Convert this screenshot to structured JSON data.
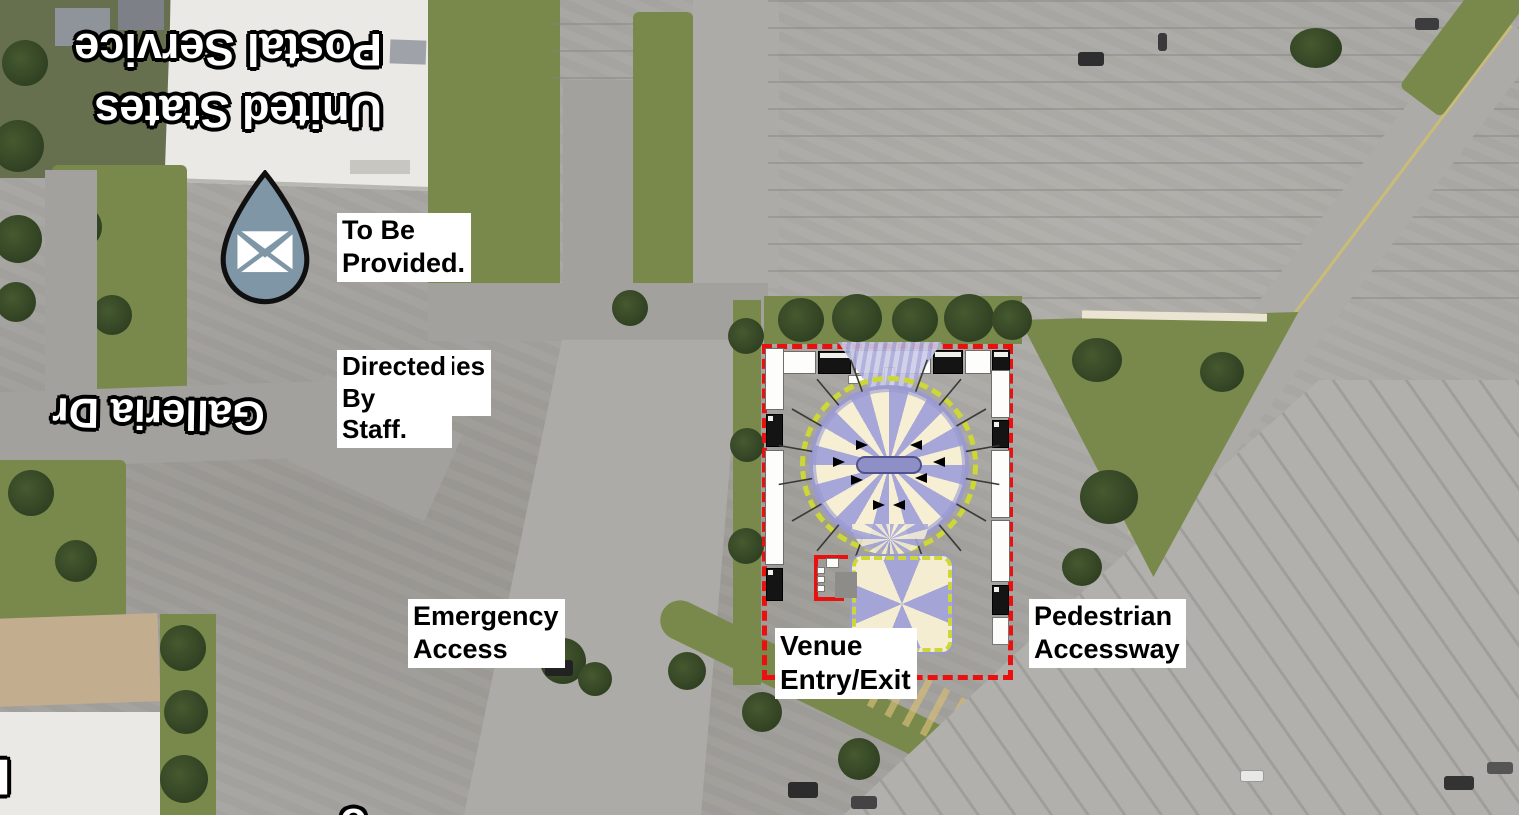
{
  "map": {
    "street_labels": {
      "postal_service": {
        "line1": "United States",
        "line2": "Postal Service"
      },
      "galleria": "Galleria Dr",
      "partial_building_letter": "F",
      "partial_edge_letter": "o"
    },
    "annotations": {
      "parking": {
        "line1": "Parking",
        "line2": "To Be Provided."
      },
      "temporary_parking": {
        "line1": "Termporary Lines",
        "line2": "Boundaries &",
        "line3": "Stalls For Parking",
        "line4": "Directed By Staff."
      },
      "emergency_access": "Emergency Access",
      "venue_entry": "Venue Entry/Exit",
      "pedestrian_accessway": "Pedestrian Accessway"
    },
    "marker": {
      "name": "postal-service-location-marker",
      "icon": "envelope-icon",
      "color": "#7E96A6"
    },
    "site_plan": {
      "boundary_color": "#E9100F",
      "tent_stripe_colors": [
        "#A6A6D8",
        "#F6EFD4"
      ],
      "tent_trim_color": "#CDD836",
      "truck_rows": {
        "top": 3,
        "left": 2,
        "right": 3
      }
    }
  }
}
